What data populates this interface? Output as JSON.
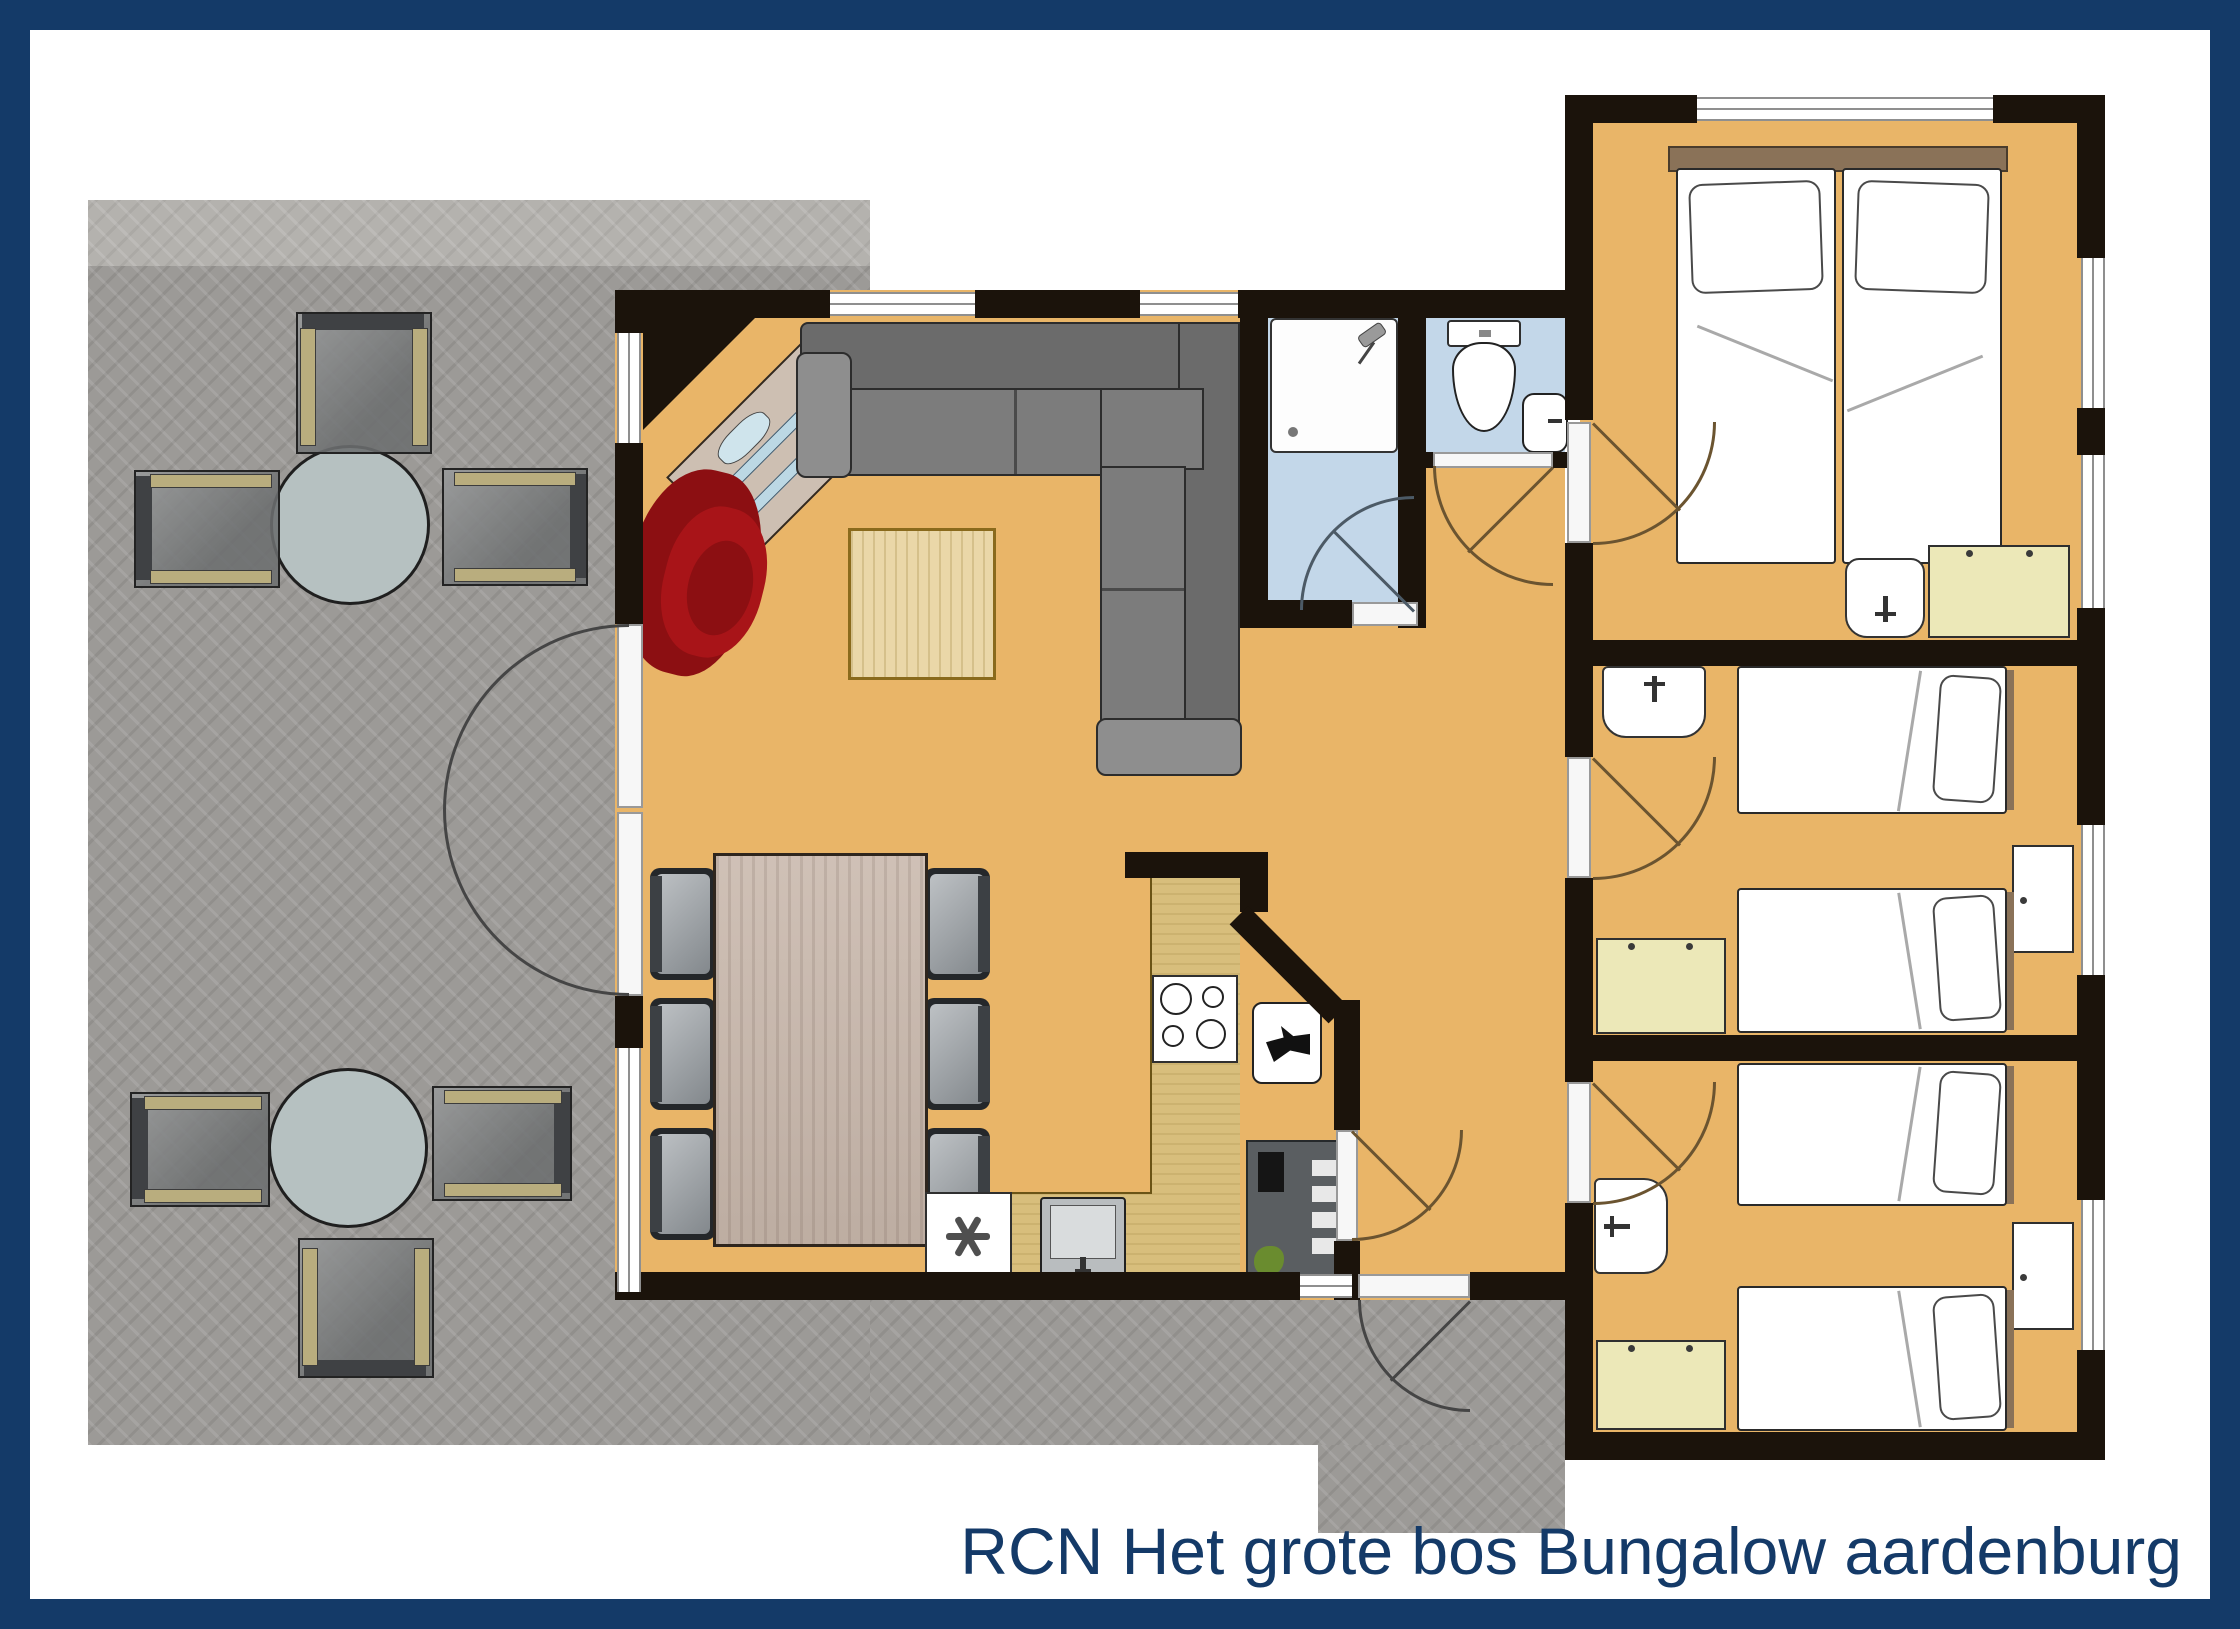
{
  "caption": {
    "text": "RCN Het grote bos Bungalow aardenburg"
  },
  "palette": {
    "navy": "#143a68",
    "wall": "#1b130b",
    "floor": "#e9b568",
    "bath": "#c3d7e9",
    "terrace": "#9c9a97",
    "terraceL": "#b4b2ae",
    "wood": "#d8be7c",
    "cab": "#ece8b8",
    "sofa": "#7c7c7c",
    "red1": "#8c0f12",
    "red2": "#a81418",
    "twood": "#c9b8ac",
    "ctable": "#ead7a8",
    "winf": "#8f8f8f",
    "arc": "#6b5430"
  },
  "plan": {
    "type": "bungalow-floor-plan",
    "rooms": [
      {
        "name": "terrace",
        "floor": "grey-paving",
        "furniture": [
          "round-table",
          "garden-chair",
          "garden-chair",
          "garden-chair",
          "round-table",
          "garden-chair",
          "garden-chair",
          "garden-chair"
        ]
      },
      {
        "name": "living-room",
        "floor": "orange",
        "furniture": [
          "corner-sideboard",
          "corner-sofa",
          "red-armchair",
          "coffee-table",
          "dining-table",
          "dining-chair x6",
          "french-doors",
          "windows"
        ]
      },
      {
        "name": "kitchen",
        "floor": "orange",
        "furniture": [
          "l-shaped-counter",
          "hob-4-burners",
          "sink",
          "freezer-asterisk"
        ]
      },
      {
        "name": "bathroom",
        "floor": "light-blue",
        "furniture": [
          "shower-tray",
          "door"
        ]
      },
      {
        "name": "toilet-room",
        "floor": "light-blue",
        "furniture": [
          "toilet",
          "wash-basin",
          "door"
        ]
      },
      {
        "name": "hallway",
        "floor": "orange",
        "furniture": [
          "boiler-cabinet",
          "heater-unit",
          "entrance-door"
        ]
      },
      {
        "name": "bedroom-double",
        "floor": "orange",
        "furniture": [
          "double-bed",
          "pillow x2",
          "wash-basin",
          "wardrobe",
          "windows",
          "door"
        ]
      },
      {
        "name": "bedroom-twin-middle",
        "floor": "orange",
        "furniture": [
          "single-bed x2",
          "wash-basin",
          "wardrobe",
          "nightstand",
          "window",
          "door"
        ]
      },
      {
        "name": "bedroom-twin-bottom",
        "floor": "orange",
        "furniture": [
          "single-bed x2",
          "wash-basin",
          "wardrobe",
          "nightstand",
          "window",
          "door"
        ]
      }
    ]
  }
}
